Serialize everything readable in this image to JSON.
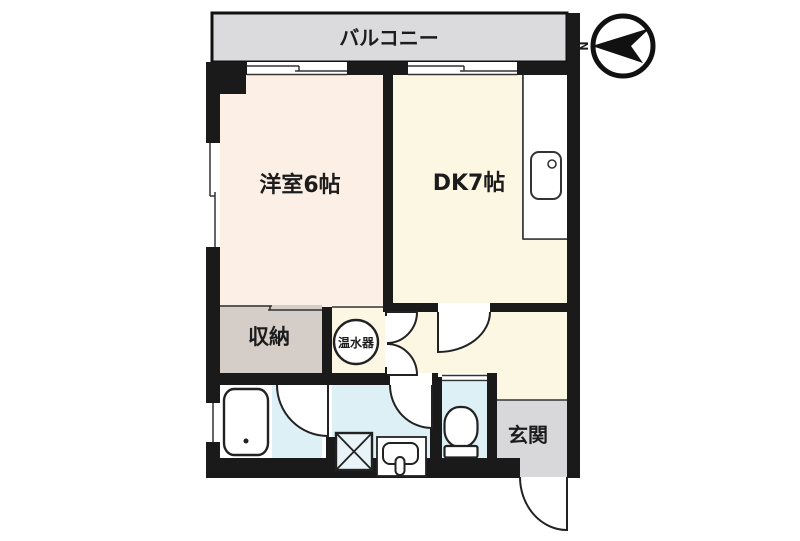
{
  "labels": {
    "balcony": "バルコニー",
    "western_room": "洋室6帖",
    "dining_kitchen": "DK7帖",
    "storage": "収納",
    "water_heater": "温水器",
    "entrance": "玄関"
  },
  "compass": {
    "north_label": "N"
  },
  "colors": {
    "wall": "#1a1a1a",
    "balcony_floor": "#dbdbdd",
    "western_room_floor": "#fcf0e6",
    "dk_floor": "#fbf7e2",
    "hallway_floor": "#fbf7e2",
    "storage_floor": "#d5cdc7",
    "wet_area_floor": "#ddf0f6",
    "entrance_floor": "#d8d8da",
    "fixture_fill": "#ffffff",
    "line": "#2a2a2a"
  }
}
